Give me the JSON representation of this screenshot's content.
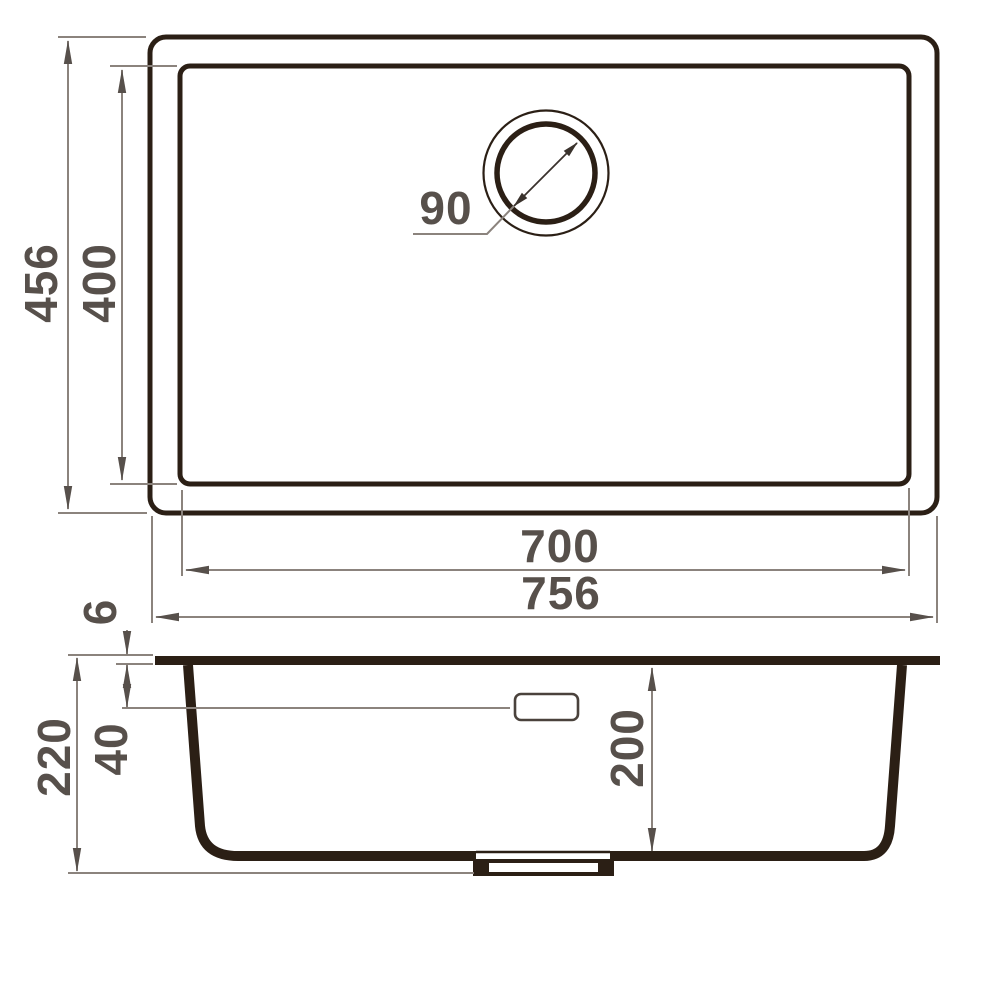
{
  "drawing": {
    "type": "technical-drawing",
    "subject": "undermount-sink-dimension-diagram",
    "background_color": "#ffffff",
    "colors": {
      "outline": "#2b1f15",
      "dimension_line": "#8b837d",
      "dimension_text": "#57504b"
    },
    "top_view": {
      "labels": {
        "overall_depth": "456",
        "bowl_depth": "400",
        "drain_diameter": "90",
        "bowl_width": "700",
        "overall_width": "756"
      }
    },
    "section_view": {
      "labels": {
        "rim_thickness": "6",
        "total_height": "220",
        "overflow_offset": "40",
        "bowl_inner_depth": "200"
      }
    }
  }
}
